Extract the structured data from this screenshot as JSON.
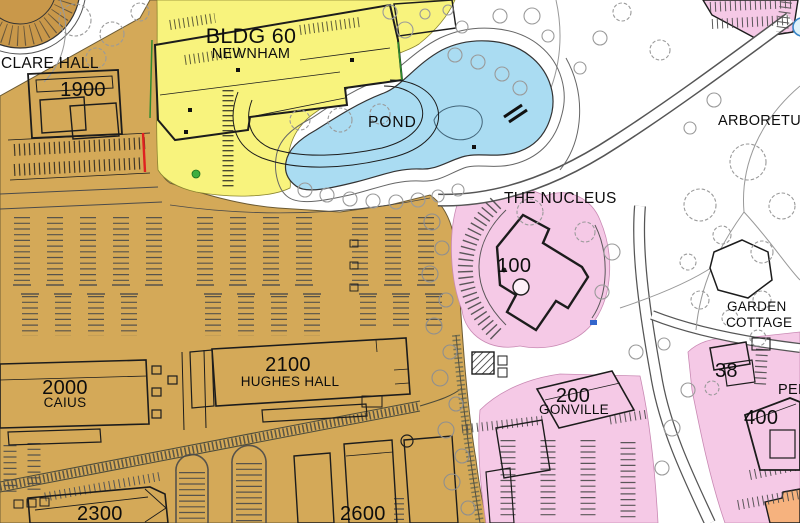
{
  "map": {
    "type": "campus-site-plan",
    "labels": {
      "clare_hall": "CLARE HALL",
      "bldg_1900": "1900",
      "bldg_60": "BLDG 60",
      "bldg_60_name": "NEWNHAM",
      "pond": "POND",
      "arboretum": "ARBORETUM",
      "nucleus": "THE NUCLEUS",
      "bldg_100": "100",
      "garden_cottage_1": "GARDEN",
      "garden_cottage_2": "COTTAGE",
      "bldg_2000": "2000",
      "bldg_2000_name": "CAIUS",
      "bldg_2100": "2100",
      "bldg_2100_name": "HUGHES HALL",
      "bldg_2300": "2300",
      "bldg_2600": "2600",
      "bldg_200": "200",
      "bldg_200_name": "GONVILLE",
      "bldg_38": "38",
      "bldg_400": "400",
      "pembroke_partial": "PEM"
    },
    "colors": {
      "parcel_tan": "#D4A958",
      "parcel_tan_dark": "#C9984A",
      "parcel_yellow": "#F8F37D",
      "parcel_pink": "#F5C9E6",
      "pond_blue": "#AADCF2",
      "building_orange": "#F6B27E",
      "outline_dark": "#1c1c1c",
      "road_line": "#555555",
      "tree_gray": "#9a9a9a",
      "accent_red": "#e02020",
      "accent_green": "#3fae3f",
      "accent_blue": "#3a86c8"
    }
  }
}
